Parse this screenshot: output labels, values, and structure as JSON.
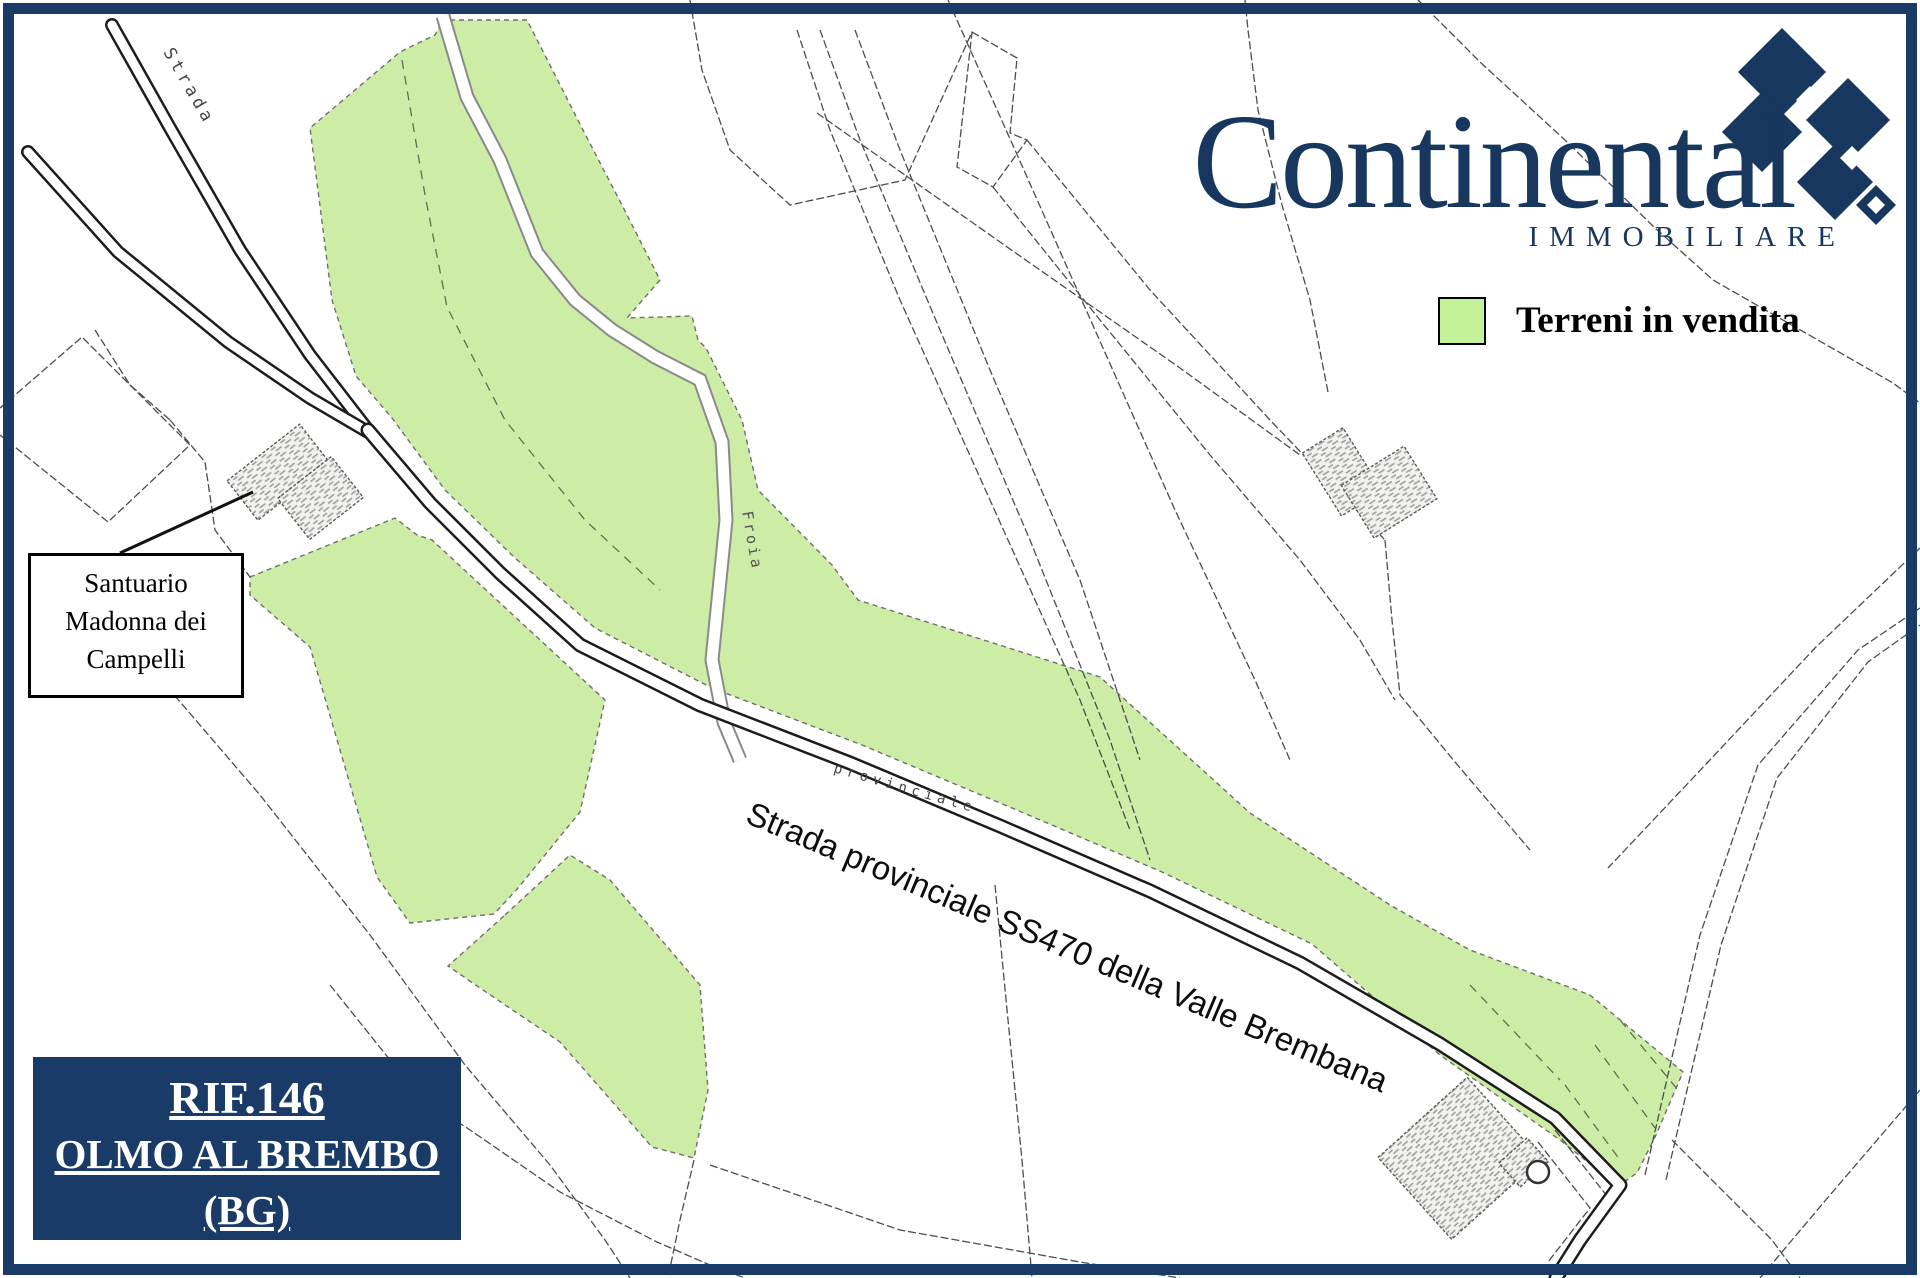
{
  "frame": {
    "border_color": "#1a3a68"
  },
  "logo": {
    "brand": "Continental",
    "subtitle": "IMMOBILIARE",
    "color": "#17375f"
  },
  "legend": {
    "label": "Terreni in vendita",
    "swatch_color": "#c3f298"
  },
  "map": {
    "parcel_color": "#cdeda6",
    "labels": {
      "strada": "Strada",
      "froia": "Froia",
      "provinciale": "provinciale",
      "main_road": "Strada provinciale SS470 della Valle Brembana"
    },
    "annotation": {
      "line1": "Santuario",
      "line2": "Madonna dei",
      "line3": "Campelli"
    }
  },
  "ref_box": {
    "reference": "RIF.146",
    "location": "OLMO AL BREMBO",
    "province": "(BG)",
    "bg_color": "#1a3a68",
    "text_color": "#ffffff"
  }
}
